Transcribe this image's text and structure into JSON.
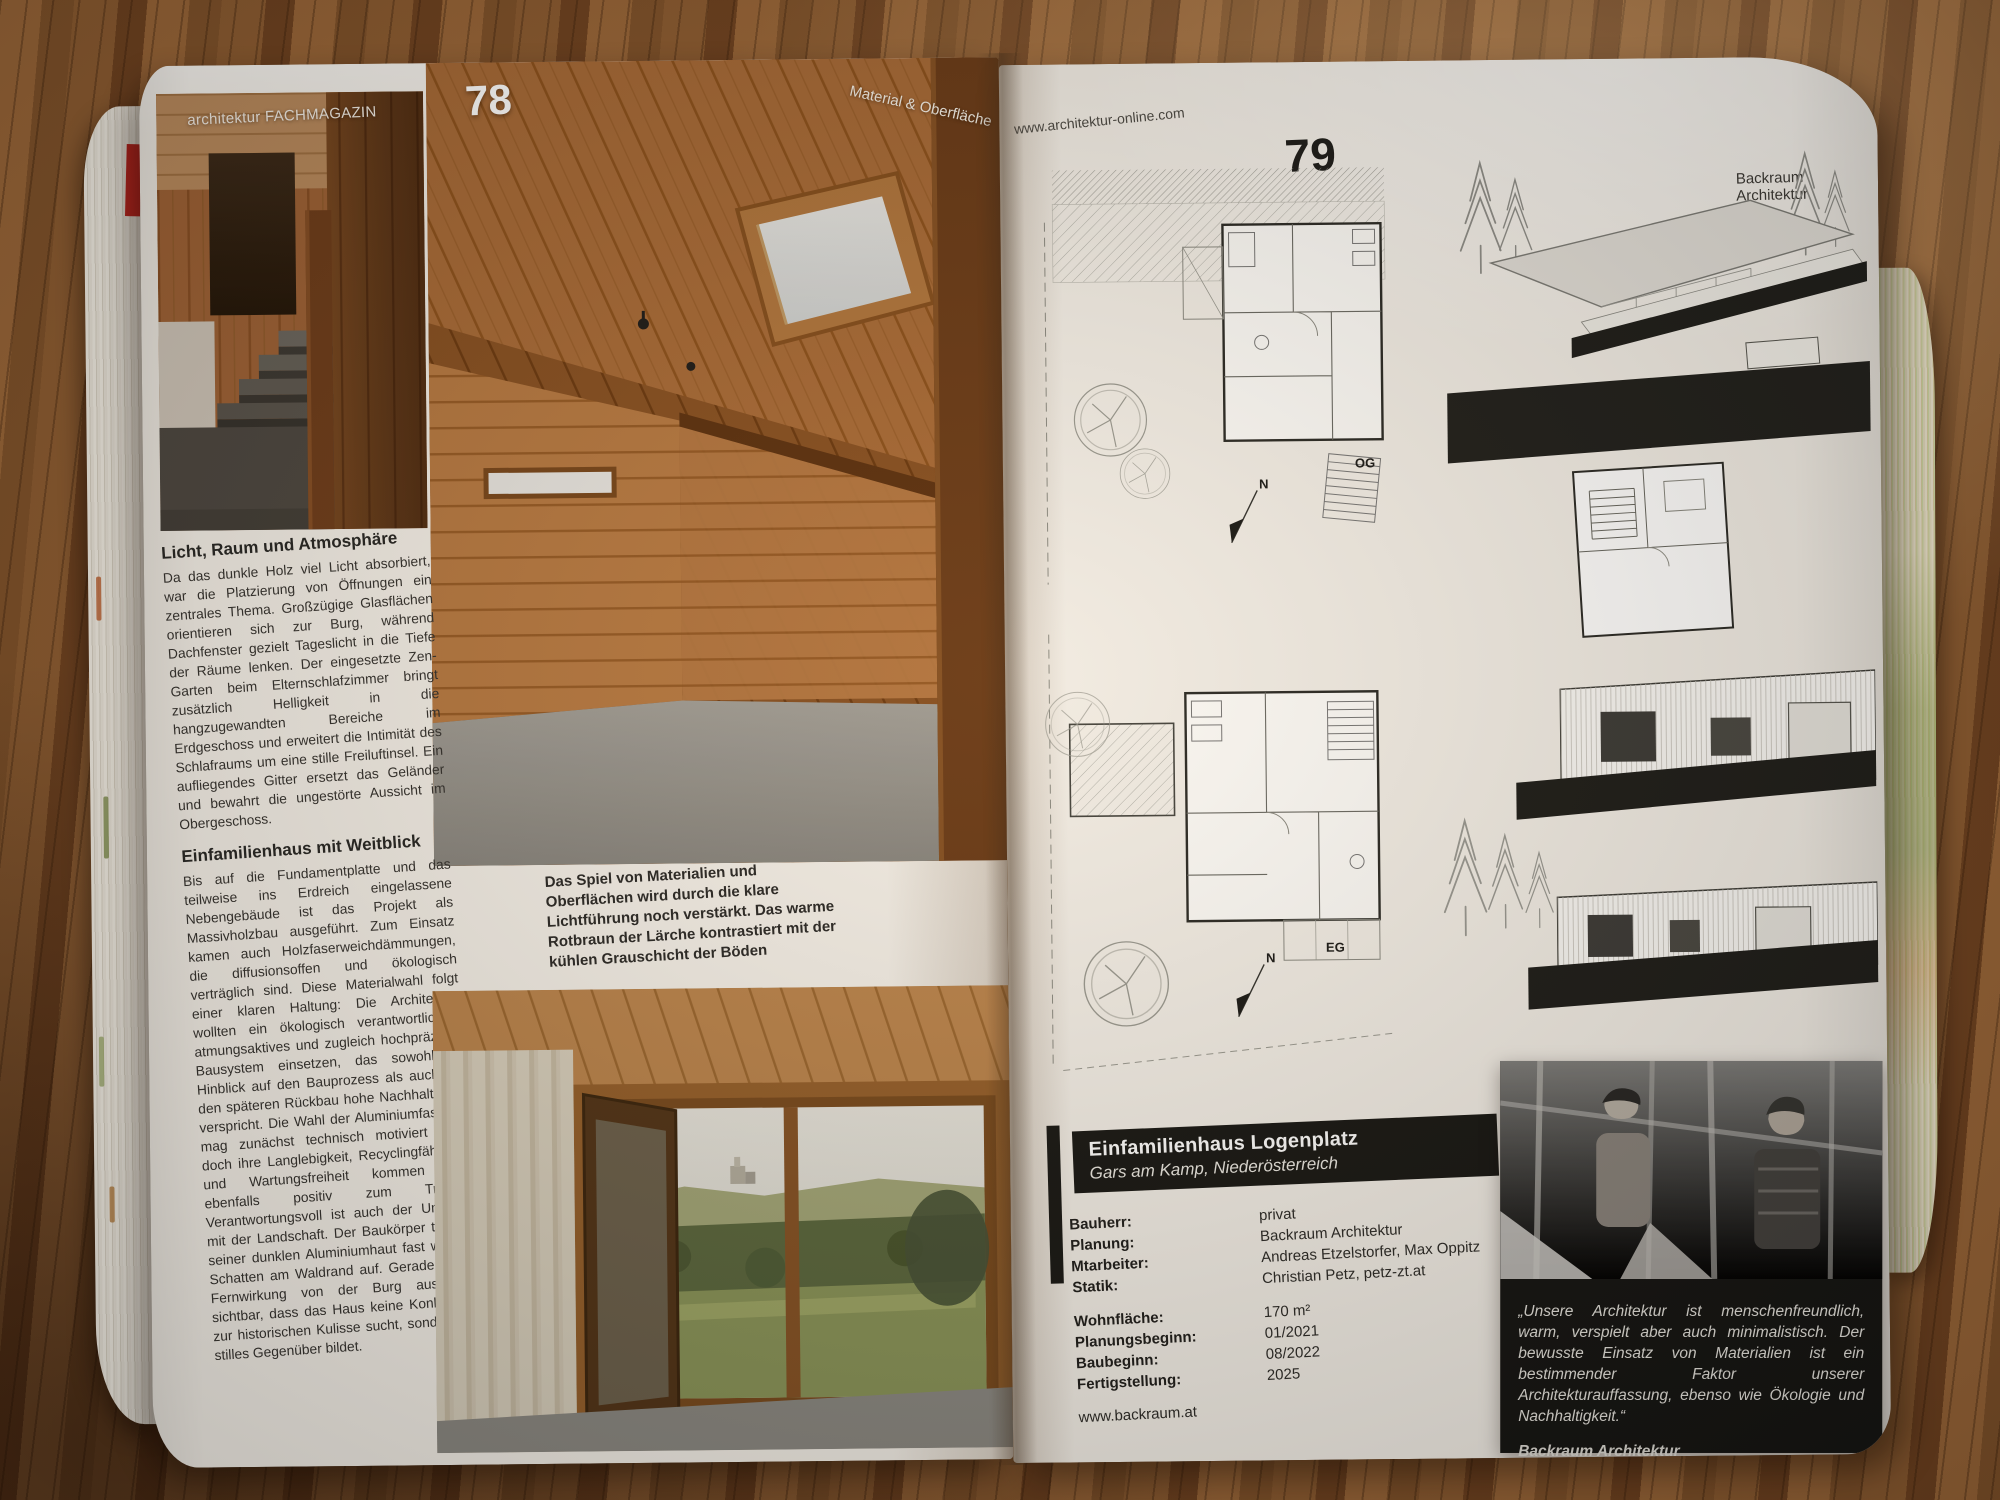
{
  "left_page": {
    "brand": "architektur FACHMAGAZIN",
    "page_number": "78",
    "section_label": "Material & Oberfläche",
    "article": {
      "heading_1": "Licht, Raum und Atmosphäre",
      "paragraph_1": "Da das dunkle Holz viel Licht absorbiert, war die Platzierung von Öffnungen ein zentrales Thema. Großzügige Glasflächen orientieren sich zur Burg, während Dachfenster gezielt Tageslicht in die Tiefe der Räume lenken. Der eingesetzte Zen-Garten beim Elternschlafzimmer bringt zusätzlich Helligkeit in die hangzugewandten Bereiche im Erdgeschoss und erweitert die Intimität des Schlafraums um eine stille Freiluftinsel. Ein aufliegendes Gitter ersetzt das Geländer und bewahrt die ungestörte Aussicht im Obergeschoss.",
      "heading_2": "Einfamilienhaus mit Weitblick",
      "paragraph_2": "Bis auf die Fundamentplatte und das teilweise ins Erdreich eingelassene Nebengebäude ist das Projekt als Massivholzbau ausgeführt. Zum Einsatz kamen auch Holzfaserweichdämmungen, die diffusionsoffen und ökologisch verträglich sind. Diese Materialwahl folgt einer klaren Haltung: Die Architekten wollten ein ökologisch verantwortliches, atmungsaktives und zugleich hochpräzises Bausystem einsetzen, das sowohl im Hinblick auf den Bauprozess als auch auf den späteren Rückbau hohe Nachhaltigkeit verspricht. Die Wahl der Aluminiumfassade mag zunächst technisch motiviert sein, doch ihre Langlebigkeit, Recyclingfähigkeit und Wartungsfreiheit kommen hier ebenfalls positiv zum Tragen. Verantwortungsvoll ist auch der Umgang mit der Landschaft. Der Baukörper tritt mit seiner dunklen Aluminiumhaut fast wie ein Schatten am Waldrand auf. Gerade in der Fernwirkung von der Burg aus wird sichtbar, dass das Haus keine Konkurrenz zur historischen Kulisse sucht, sondern ein stilles Gegenüber bildet.",
      "end_mark": "■"
    },
    "photo_caption": "Das Spiel von Materialien und Oberflächen wird durch die klare Lichtführung noch verstärkt. Das warme Rotbraun der Lärche kontrastiert mit der kühlen Grauschicht der Böden"
  },
  "right_page": {
    "website": "www.architektur-online.com",
    "page_number": "79",
    "studio": "Backraum Architektur",
    "plans": {
      "upper_label": "OG",
      "lower_label": "EG",
      "north_mark": "N"
    },
    "project": {
      "title": "Einfamilienhaus Logenplatz",
      "location": "Gars am Kamp, Niederösterreich",
      "details": [
        {
          "label": "Bauherr:",
          "value": "privat"
        },
        {
          "label": "Planung:",
          "value": "Backraum Architektur"
        },
        {
          "label": "Mtarbeiter:",
          "value": "Andreas Etzelstorfer, Max Oppitz"
        },
        {
          "label": "Statik:",
          "value": "Christian Petz, petz-zt.at"
        }
      ],
      "facts": [
        {
          "label": "Wohnfläche:",
          "value": "170 m²"
        },
        {
          "label": "Planungsbeginn:",
          "value": "01/2021"
        },
        {
          "label": "Baubeginn:",
          "value": "08/2022"
        },
        {
          "label": "Fertigstellung:",
          "value": "2025"
        }
      ],
      "website": "www.backraum.at"
    },
    "quote": {
      "text": "„Unsere Architektur ist menschenfreundlich, warm, verspielt aber auch minimalistisch. Der bewusste Einsatz von Materialien ist ein bestimmender Faktor unserer Architekturauffassung, ebenso wie Ökologie und Nachhaltigkeit.“",
      "attribution": "Backraum Architektur"
    }
  },
  "colors": {
    "bookmark_red": "#c0241f",
    "page": "#f3efe8",
    "ink": "#1d1d1b",
    "panel_black": "#181815",
    "table_wood": "#8a5732"
  }
}
